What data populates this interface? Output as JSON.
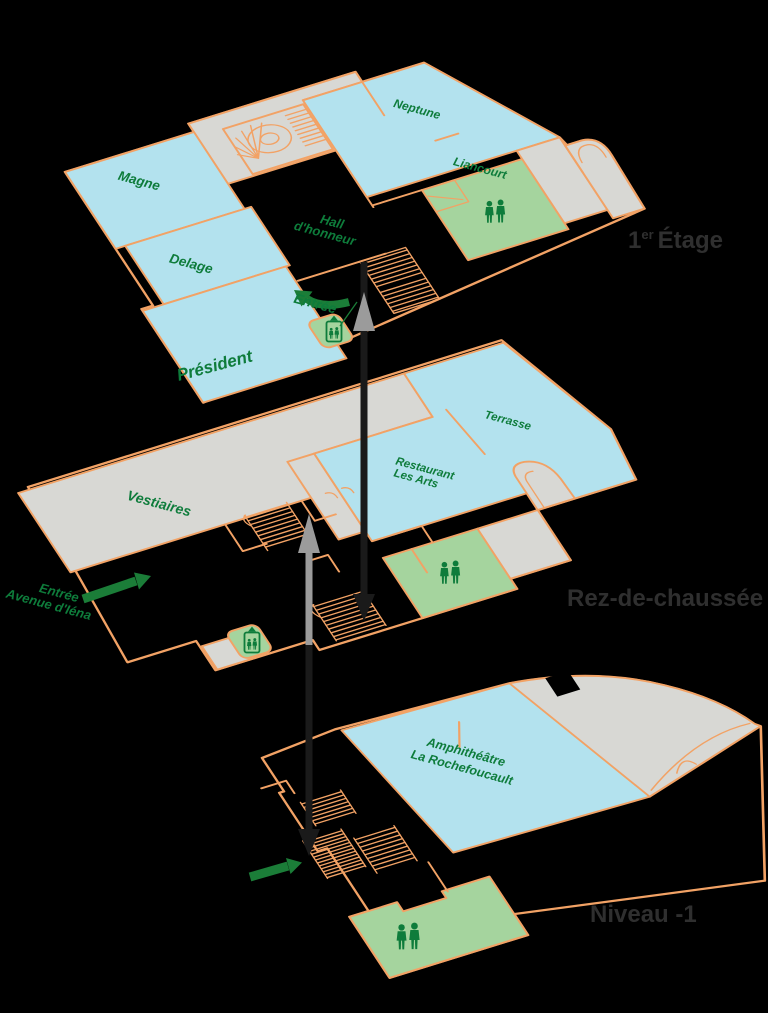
{
  "floor_labels": {
    "etage1": {
      "num": "1",
      "sup": "er",
      "name": "Étage"
    },
    "rdc": "Rez-de-chaussée",
    "niveau_m1": "Niveau -1"
  },
  "rooms": {
    "magne": "Magne",
    "delage": "Delage",
    "president": "Président",
    "neptune": "Neptune",
    "liancourt": "Liancourt",
    "hall_line1": "Hall",
    "hall_line2": "d'honneur",
    "entree_etage": "Entrée",
    "vestiaires": "Vestiaires",
    "terrasse": "Terrasse",
    "restaurant_line1": "Restaurant",
    "restaurant_line2": "Les Arts",
    "entree_rdc_line1": "Entrée",
    "entree_rdc_line2": "Avenue d'Iéna",
    "amphi_line1": "Amphithéâtre",
    "amphi_line2": "La Rochefoucault"
  },
  "icons": {
    "wc": "two-person-wc-icon",
    "elevator": "elevator-icon",
    "stairs": "stair-hatching-icon",
    "spiral_stairs": "spiral-staircase-icon",
    "entrance_arrow": "green-entrance-arrow",
    "level_link_up": "gray-up-arrowhead",
    "level_link_down": "black-down-arrow"
  },
  "colors": {
    "background": "#000000",
    "wall_orange": "#F2A265",
    "room_blue": "#B3E2EE",
    "area_gray": "#D8D8D4",
    "wc_green": "#A5D49E",
    "label_green": "#0E7C3B",
    "arrow_green": "#1B7D38",
    "floor_label_gray": "#2F2F2F",
    "arrow_gray": "#9B9B9B",
    "arrow_black": "#1A1A1A"
  }
}
